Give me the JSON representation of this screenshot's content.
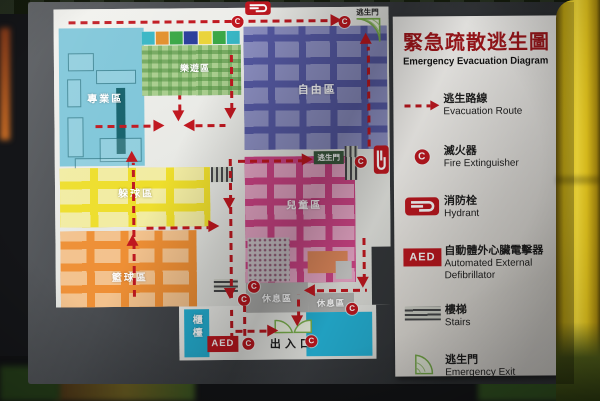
{
  "legend_panel": {
    "title_zh": "緊急疏散逃生圖",
    "title_en": "Emergency Evacuation Diagram",
    "items": [
      {
        "zh": "逃生路線",
        "en": "Evacuation Route",
        "icon": "evacuation-route-arrow"
      },
      {
        "zh": "滅火器",
        "en": "Fire Extinguisher",
        "icon": "fire-extinguisher-icon"
      },
      {
        "zh": "消防栓",
        "en": "Hydrant",
        "icon": "hydrant-icon"
      },
      {
        "zh": "自動體外心臟電擊器",
        "en": "Automated External Defibrillator",
        "icon": "aed-badge",
        "badge": "AED"
      },
      {
        "zh": "樓梯",
        "en": "Stairs",
        "icon": "stairs-icon"
      },
      {
        "zh": "逃生門",
        "en": "Emergency Exit",
        "icon": "exit-door-icon"
      }
    ]
  },
  "map": {
    "zones": [
      {
        "id": "specialty",
        "label": "專業區",
        "color": "#7fc6d9"
      },
      {
        "id": "garden",
        "label": "樂遊區",
        "color": "#a9cd8e"
      },
      {
        "id": "free",
        "label": "自由區",
        "color": "#565aa4"
      },
      {
        "id": "dodgeball",
        "label": "躲球區",
        "color": "#eede2c"
      },
      {
        "id": "basketball",
        "label": "籃球區",
        "color": "#ee8f35"
      },
      {
        "id": "kids",
        "label": "兒童區",
        "color": "#cf4587"
      },
      {
        "id": "rest1",
        "label": "休息區",
        "color": "#b2b2b0"
      },
      {
        "id": "rest2",
        "label": "休息區",
        "color": "#b2b2b0"
      }
    ],
    "labels": {
      "counter": "櫃檯",
      "entrance": "出入口",
      "exit_door_top": "逃生門",
      "exit_door_right": "逃生門",
      "aed": "AED",
      "fire_ext_glyph": "C"
    },
    "tile_colors": [
      "#38b6c4",
      "#e2902e",
      "#3aa746",
      "#2b3e9b",
      "#ead43a",
      "#3aa746",
      "#38b6c4"
    ]
  },
  "colors": {
    "route_red": "#c01820",
    "title_red": "#a6171c",
    "board_grey": "#3a3d40",
    "map_panel": "#e2e3df",
    "pole_yellow": "#e8c71c",
    "cyan": "#25b2d6",
    "exit_green": "#7cb24e"
  }
}
